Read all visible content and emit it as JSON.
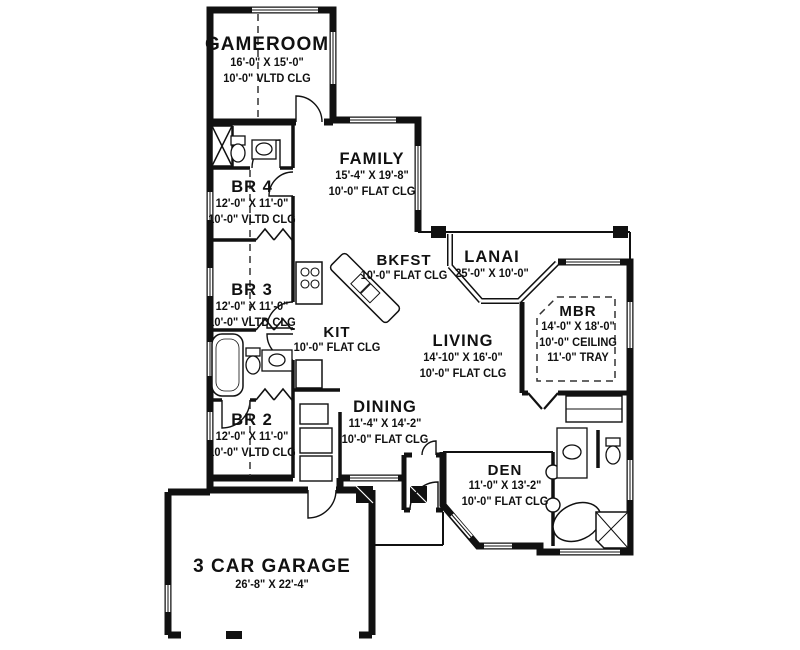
{
  "title": "house-floor-plan",
  "colors": {
    "wall": "#111111",
    "background": "#ffffff",
    "dash": "#333333"
  },
  "rooms": [
    {
      "id": "gameroom",
      "name": "GAMEROOM",
      "lines": [
        "16'-0\" X 15'-0\"",
        "10'-0\" VLTD CLG"
      ],
      "cx": 267,
      "cy": 34,
      "size": "lg"
    },
    {
      "id": "family",
      "name": "FAMILY",
      "lines": [
        "15'-4\" X 19'-8\"",
        "10'-0\" FLAT CLG"
      ],
      "cx": 372,
      "cy": 150,
      "size": "md"
    },
    {
      "id": "br4",
      "name": "BR 4",
      "lines": [
        "12'-0\" X 11'-0\"",
        "10'-0\" VLTD CLG"
      ],
      "cx": 252,
      "cy": 178,
      "size": "md"
    },
    {
      "id": "bkfst",
      "name": "BKFST",
      "lines": [
        "10'-0\" FLAT CLG"
      ],
      "cx": 404,
      "cy": 252,
      "size": "sm"
    },
    {
      "id": "lanai",
      "name": "LANAI",
      "lines": [
        "25'-0\" X 10'-0\""
      ],
      "cx": 492,
      "cy": 248,
      "size": "md"
    },
    {
      "id": "br3",
      "name": "BR 3",
      "lines": [
        "12'-0\" X 11'-0\"",
        "10'-0\" VLTD CLG"
      ],
      "cx": 252,
      "cy": 281,
      "size": "md"
    },
    {
      "id": "mbr",
      "name": "MBR",
      "lines": [
        "14'-0\" X 18'-0\"",
        "10'-0\" CEILING",
        "11'-0\" TRAY"
      ],
      "cx": 578,
      "cy": 303,
      "size": "sm"
    },
    {
      "id": "kit",
      "name": "KIT",
      "lines": [
        "10'-0\" FLAT CLG"
      ],
      "cx": 337,
      "cy": 324,
      "size": "sm"
    },
    {
      "id": "living",
      "name": "LIVING",
      "lines": [
        "14'-10\" X 16'-0\"",
        "10'-0\" FLAT CLG"
      ],
      "cx": 463,
      "cy": 332,
      "size": "md"
    },
    {
      "id": "dining",
      "name": "DINING",
      "lines": [
        "11'-4\" X 14'-2\"",
        "10'-0\" FLAT CLG"
      ],
      "cx": 385,
      "cy": 398,
      "size": "md"
    },
    {
      "id": "br2",
      "name": "BR 2",
      "lines": [
        "12'-0\" X 11'-0\"",
        "10'-0\" VLTD CLG"
      ],
      "cx": 252,
      "cy": 411,
      "size": "md"
    },
    {
      "id": "den",
      "name": "DEN",
      "lines": [
        "11'-0\" X 13'-2\"",
        "10'-0\" FLAT CLG"
      ],
      "cx": 505,
      "cy": 462,
      "size": "sm"
    },
    {
      "id": "garage",
      "name": "3 CAR GARAGE",
      "lines": [
        "26'-8\" X  22'-4\""
      ],
      "cx": 272,
      "cy": 556,
      "size": "lg"
    }
  ]
}
